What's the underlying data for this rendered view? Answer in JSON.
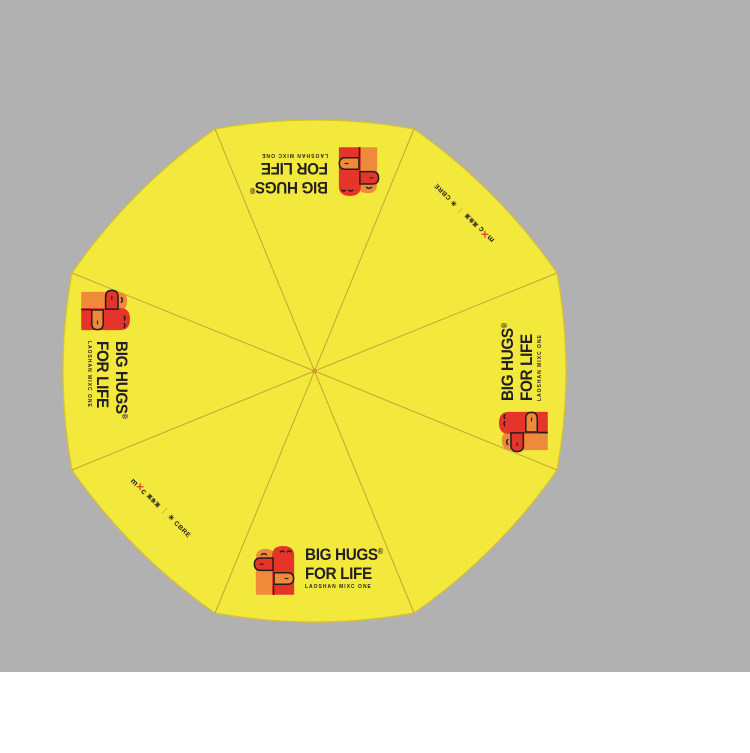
{
  "canvas": {
    "bg_gray": "#b1b1b1",
    "bg_white": "#ffffff"
  },
  "umbrella": {
    "description": "octagonal 8-panel umbrella canopy, top view",
    "panel_count": 8,
    "canopy_color": "#f3e93d",
    "seam_color": "#c79f33",
    "rim_color": "#d9c32a"
  },
  "logo": {
    "line1": "BIG HUGS",
    "registered": "®",
    "line2": "FOR LIFE",
    "line3": "LAOSHAN MIXC ONE",
    "colors": {
      "orange": "#ef8a3a",
      "red": "#e5352b",
      "ink": "#231f20"
    }
  },
  "cobrand": {
    "mixc_prefix": "m",
    "mixc_x": "✕",
    "mixc_suffix": "c",
    "mixc_cn": "萬象滙",
    "divider": "｜",
    "partner_mark": "✳",
    "partner_name": "CBRE"
  }
}
